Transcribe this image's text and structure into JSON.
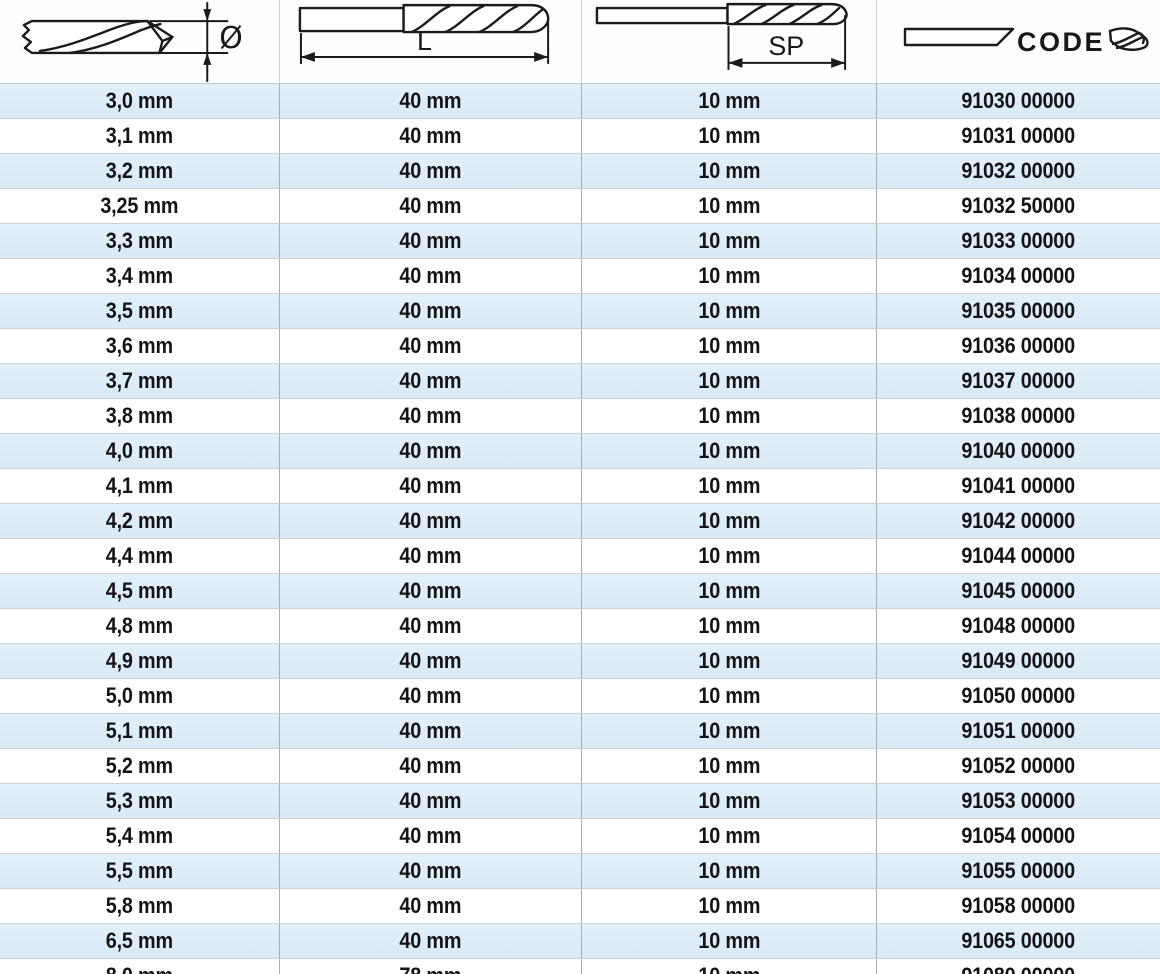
{
  "header": {
    "columns": [
      {
        "key": "diameter",
        "label": "Ø",
        "icon": "drill-diameter-icon"
      },
      {
        "key": "length",
        "label": "L",
        "icon": "drill-length-icon"
      },
      {
        "key": "spiral_length",
        "label": "SP",
        "icon": "drill-spiral-icon"
      },
      {
        "key": "code",
        "label": "CODE",
        "icon": "drill-code-icon"
      }
    ]
  },
  "rows": [
    {
      "diameter": "3,0 mm",
      "length": "40 mm",
      "spiral_length": "10 mm",
      "code": "91030 00000"
    },
    {
      "diameter": "3,1 mm",
      "length": "40 mm",
      "spiral_length": "10 mm",
      "code": "91031 00000"
    },
    {
      "diameter": "3,2 mm",
      "length": "40 mm",
      "spiral_length": "10 mm",
      "code": "91032 00000"
    },
    {
      "diameter": "3,25 mm",
      "length": "40 mm",
      "spiral_length": "10 mm",
      "code": "91032 50000"
    },
    {
      "diameter": "3,3 mm",
      "length": "40 mm",
      "spiral_length": "10 mm",
      "code": "91033 00000"
    },
    {
      "diameter": "3,4 mm",
      "length": "40 mm",
      "spiral_length": "10 mm",
      "code": "91034 00000"
    },
    {
      "diameter": "3,5 mm",
      "length": "40 mm",
      "spiral_length": "10 mm",
      "code": "91035 00000"
    },
    {
      "diameter": "3,6 mm",
      "length": "40 mm",
      "spiral_length": "10 mm",
      "code": "91036 00000"
    },
    {
      "diameter": "3,7 mm",
      "length": "40 mm",
      "spiral_length": "10 mm",
      "code": "91037 00000"
    },
    {
      "diameter": "3,8 mm",
      "length": "40 mm",
      "spiral_length": "10 mm",
      "code": "91038 00000"
    },
    {
      "diameter": "4,0 mm",
      "length": "40 mm",
      "spiral_length": "10 mm",
      "code": "91040 00000"
    },
    {
      "diameter": "4,1 mm",
      "length": "40 mm",
      "spiral_length": "10 mm",
      "code": "91041 00000"
    },
    {
      "diameter": "4,2 mm",
      "length": "40 mm",
      "spiral_length": "10 mm",
      "code": "91042 00000"
    },
    {
      "diameter": "4,4 mm",
      "length": "40 mm",
      "spiral_length": "10 mm",
      "code": "91044 00000"
    },
    {
      "diameter": "4,5 mm",
      "length": "40 mm",
      "spiral_length": "10 mm",
      "code": "91045 00000"
    },
    {
      "diameter": "4,8 mm",
      "length": "40 mm",
      "spiral_length": "10 mm",
      "code": "91048 00000"
    },
    {
      "diameter": "4,9 mm",
      "length": "40 mm",
      "spiral_length": "10 mm",
      "code": "91049 00000"
    },
    {
      "diameter": "5,0 mm",
      "length": "40 mm",
      "spiral_length": "10 mm",
      "code": "91050 00000"
    },
    {
      "diameter": "5,1 mm",
      "length": "40 mm",
      "spiral_length": "10 mm",
      "code": "91051 00000"
    },
    {
      "diameter": "5,2 mm",
      "length": "40 mm",
      "spiral_length": "10 mm",
      "code": "91052 00000"
    },
    {
      "diameter": "5,3 mm",
      "length": "40 mm",
      "spiral_length": "10 mm",
      "code": "91053 00000"
    },
    {
      "diameter": "5,4 mm",
      "length": "40 mm",
      "spiral_length": "10 mm",
      "code": "91054 00000"
    },
    {
      "diameter": "5,5 mm",
      "length": "40 mm",
      "spiral_length": "10 mm",
      "code": "91055 00000"
    },
    {
      "diameter": "5,8 mm",
      "length": "40 mm",
      "spiral_length": "10 mm",
      "code": "91058 00000"
    },
    {
      "diameter": "6,5 mm",
      "length": "40 mm",
      "spiral_length": "10 mm",
      "code": "91065 00000"
    },
    {
      "diameter": "8,0 mm",
      "length": "78 mm",
      "spiral_length": "10 mm",
      "code": "91080 00000"
    }
  ],
  "colors": {
    "row_alt": "#d9eaf6",
    "row_base": "#ffffff",
    "row_line": "#ccd1d6",
    "col_line": "#a9aeb4",
    "ink": "#141417"
  }
}
